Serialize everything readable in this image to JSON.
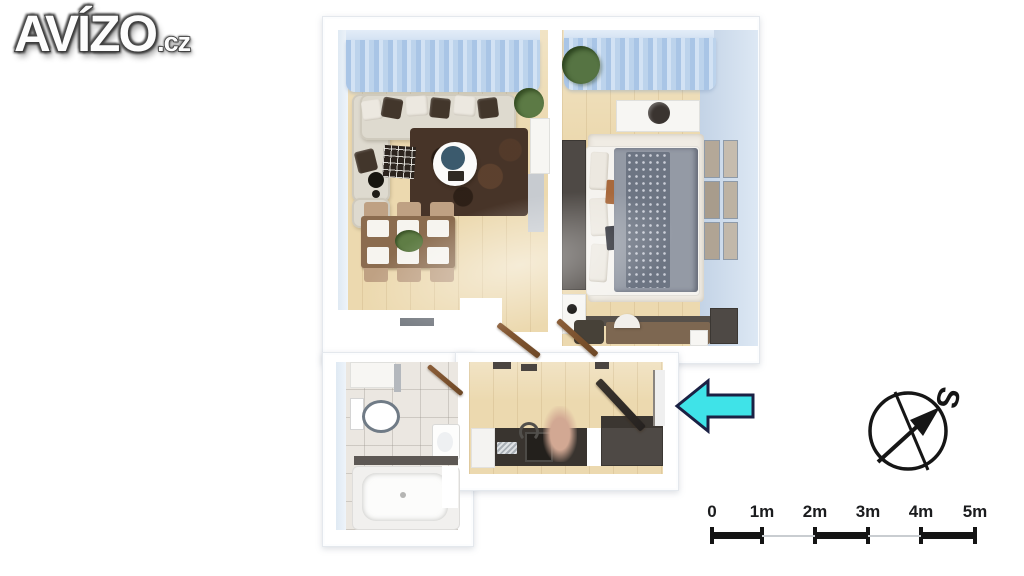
{
  "logo": {
    "brand": "AVÍZO",
    "tld": ".cz"
  },
  "floor_plan": {
    "type": "3d-apartment-floor-plan-top-view",
    "rooms": [
      "living-room-with-dining-area",
      "bedroom",
      "bathroom",
      "kitchen-hall"
    ]
  },
  "annotations": {
    "entrance_arrow": {
      "icon": "left-arrow",
      "fill": "#3FE3E8",
      "outline": "#1B2144"
    },
    "compass": {
      "icon": "compass-cross-circle-arrow",
      "label": "S"
    },
    "scale_bar": {
      "labels": [
        "0",
        "1m",
        "2m",
        "3m",
        "4m",
        "5m"
      ]
    }
  },
  "colors": {
    "background": "#FFFFFF",
    "walls": "#FFFFFF",
    "curtains": "#B5CDE8",
    "wood_floor": "#ECD9AF",
    "living_rug": "#473428",
    "bed_blanket": "#949AA5",
    "bed_throw_pattern": "#6D7583",
    "dark_furniture": "#4E4945",
    "bathroom_tile": "#EBE7E1",
    "ink": "#141414"
  }
}
